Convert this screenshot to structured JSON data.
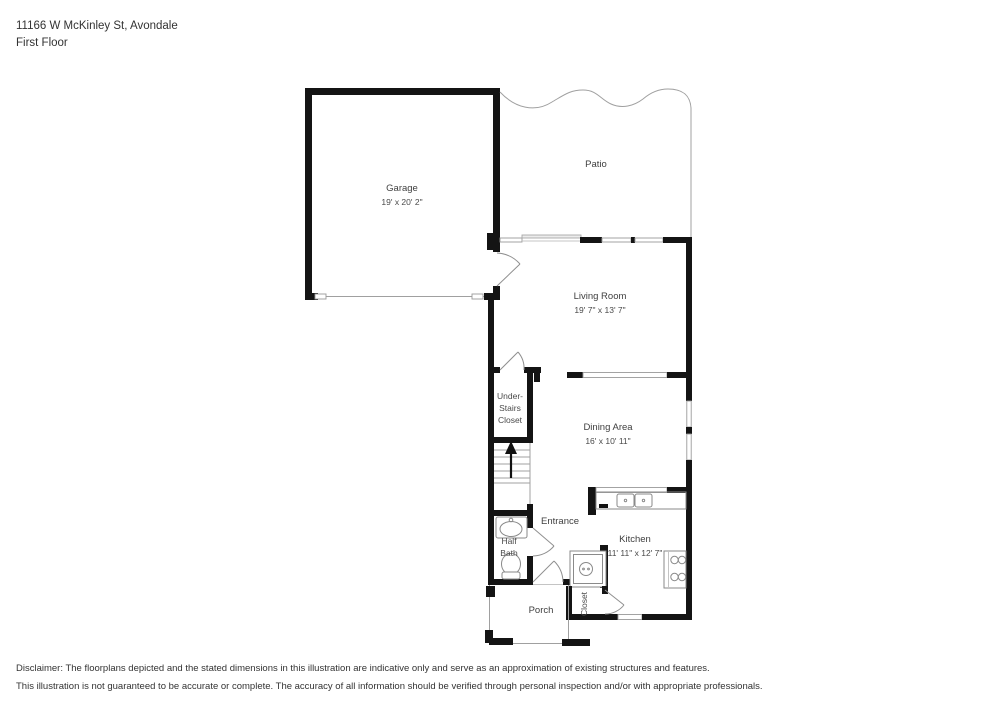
{
  "header": {
    "address": "11166 W McKinley St, Avondale",
    "floor_label": "First Floor"
  },
  "rooms": {
    "garage": {
      "name": "Garage",
      "dims": "19' x 20' 2\""
    },
    "patio": {
      "name": "Patio"
    },
    "living_room": {
      "name": "Living Room",
      "dims": "19' 7\" x 13' 7\""
    },
    "under_stairs_closet": {
      "name_line1": "Under-",
      "name_line2": "Stairs",
      "name_line3": "Closet"
    },
    "dining_area": {
      "name": "Dining Area",
      "dims": "16' x 10' 11\""
    },
    "entrance": {
      "name": "Entrance"
    },
    "half_bath": {
      "name_line1": "Half",
      "name_line2": "Bath"
    },
    "kitchen": {
      "name": "Kitchen",
      "dims": "11' 11\" x 12' 7\""
    },
    "closet": {
      "name": "Closet"
    },
    "porch": {
      "name": "Porch"
    }
  },
  "disclaimer": {
    "line1": "Disclaimer: The floorplans depicted and the stated dimensions in this illustration are indicative only and serve as an approximation of existing structures and features.",
    "line2": "This illustration is not guaranteed to be accurate or complete. The accuracy of all information should be verified through personal inspection and/or with appropriate professionals."
  },
  "colors": {
    "wall": "#141414",
    "thin_line": "#a0a0a0",
    "text": "#3f3f3f"
  }
}
